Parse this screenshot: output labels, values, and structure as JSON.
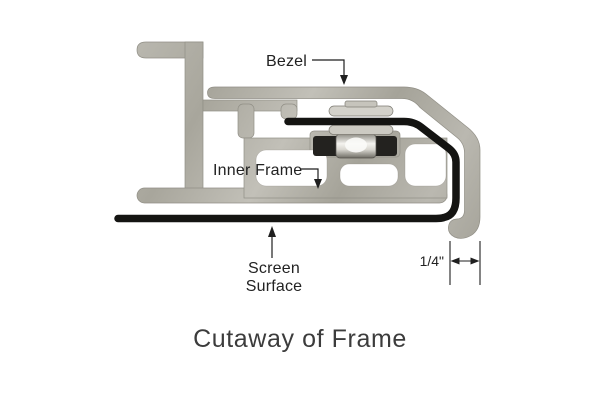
{
  "diagram": {
    "title": "Cutaway of Frame",
    "labels": {
      "bezel": "Bezel",
      "inner_frame": "Inner Frame",
      "screen_surface_line1": "Screen",
      "screen_surface_line2": "Surface",
      "dimension": "1/4\""
    },
    "parts": {
      "bezel": "outer bezel extrusion with right-side return and J-curl",
      "inner_frame": "inner frame extrusion with hollow slots",
      "screen_surface": "black screen material wrapped around right edge and held by snap fastener",
      "snap_fastener": "snap/plunger fixing screen to inner frame",
      "dimension_note": "1/4 inch offset between screen surface plane and outer bezel edge"
    },
    "colors": {
      "background": "#ffffff",
      "metal_base": "#b1afa7",
      "metal_light": "#c9c7bf",
      "metal_dark": "#9b998f",
      "metal_outline": "#918f86",
      "screen_black": "#141412",
      "line_color": "#1f1f1f",
      "title_color": "#3c3c3c"
    }
  }
}
